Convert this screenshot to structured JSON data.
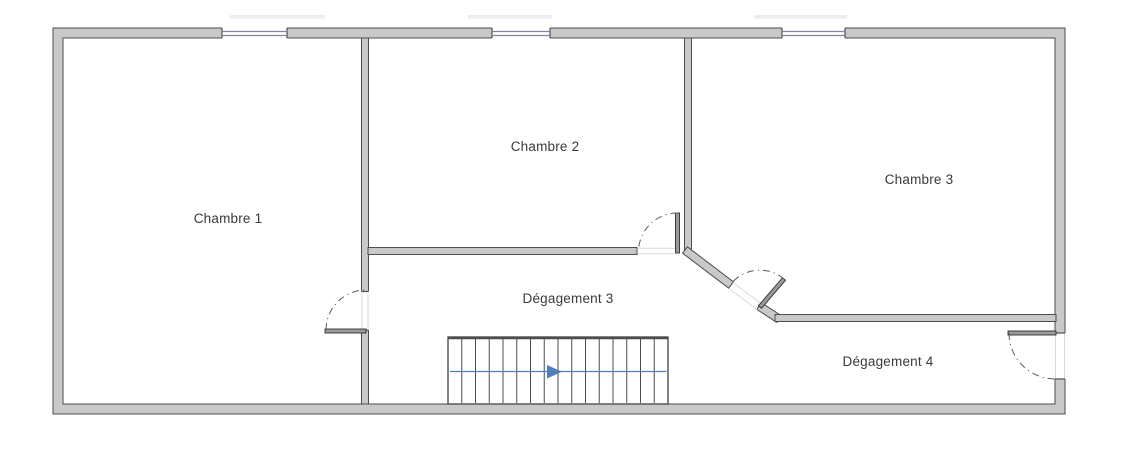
{
  "plan": {
    "rooms": [
      {
        "label": "Chambre 1"
      },
      {
        "label": "Chambre 2"
      },
      {
        "label": "Chambre 3"
      },
      {
        "label": "Dégagement 3"
      },
      {
        "label": "Dégagement 4"
      }
    ],
    "stairs": {
      "treads": 16,
      "direction": "right"
    },
    "features": {
      "windows": 3,
      "door_swings": 4
    },
    "colors": {
      "wall_fill": "#c9c9c9",
      "wall_outline": "#4d4d4d",
      "window_line": "#8282a2",
      "stair_arrow": "#4e7fbe",
      "label_text": "#3a3a3a"
    }
  }
}
